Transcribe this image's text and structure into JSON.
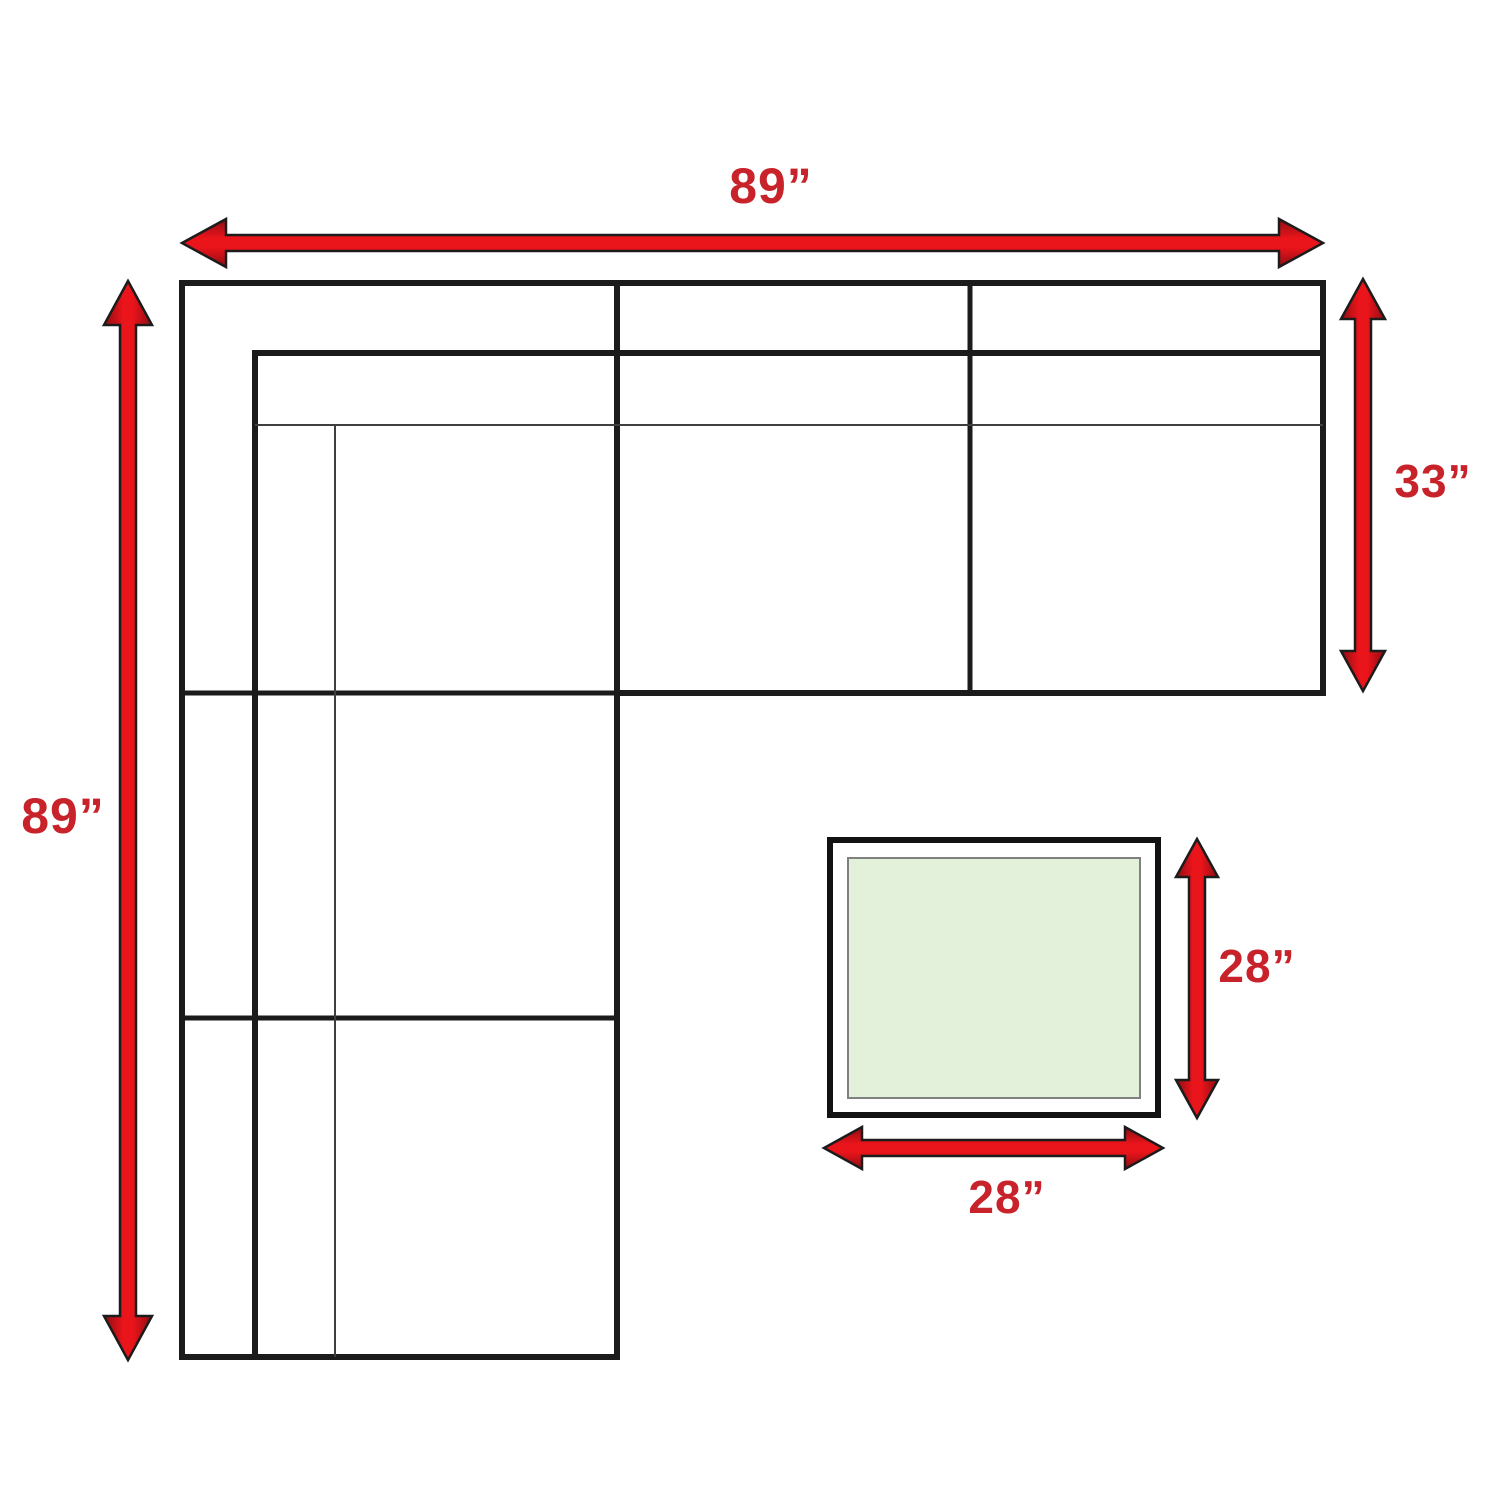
{
  "labels": {
    "sofa_width": "89”",
    "sofa_depth": "89”",
    "chaise_depth": "33”",
    "ottoman_depth": "28”",
    "ottoman_width": "28”"
  },
  "colors": {
    "arrow_red": "#e2151c",
    "label_red": "#c8232a",
    "line_black": "#1b1b1b",
    "ottoman_fill": "#e3f0da"
  }
}
